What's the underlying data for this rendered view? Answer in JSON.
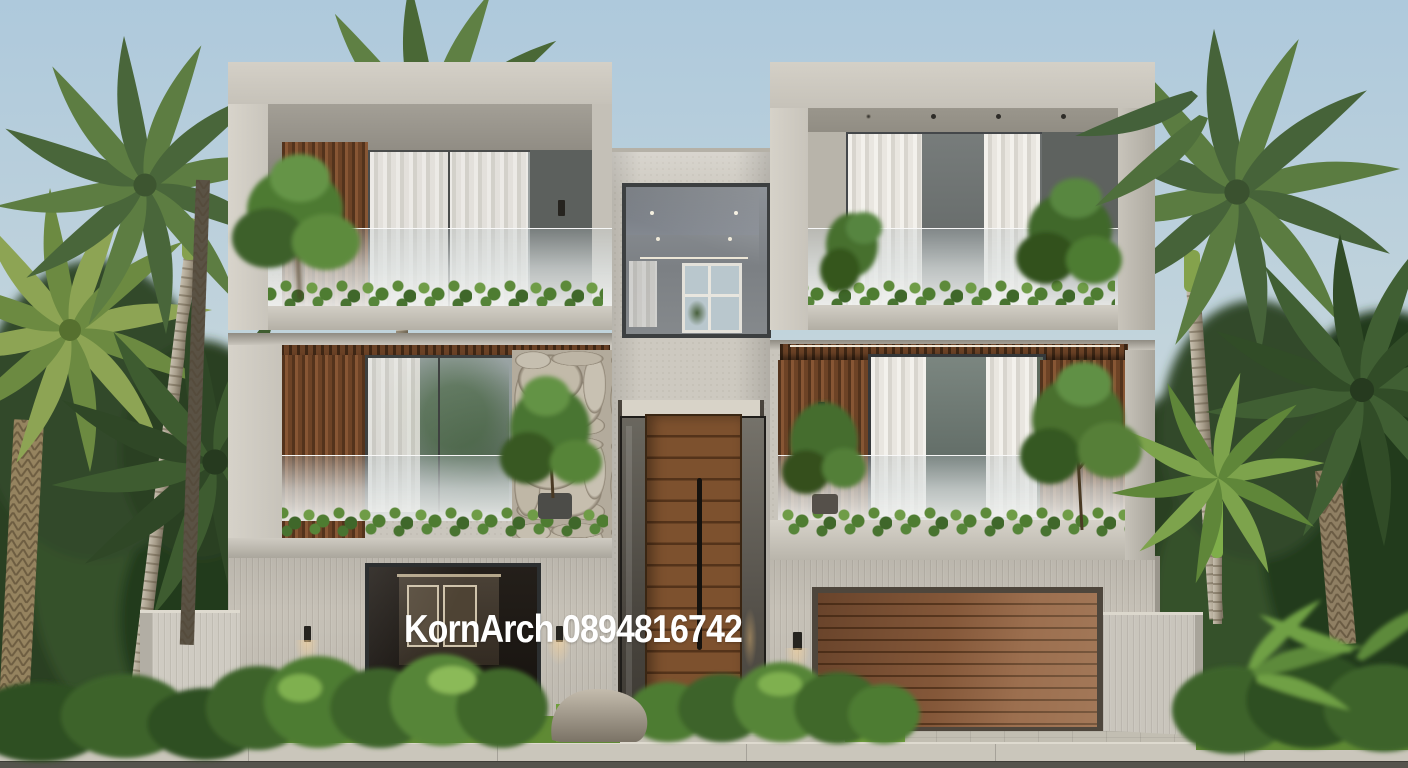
{
  "watermark": {
    "text": "KornArch 0894816742",
    "color": "#ffffff"
  },
  "scene": {
    "type": "3d-architectural-exterior-render",
    "subject": "modern three-storey concrete villa with wood accents, planted balconies, double garage and tropical palms",
    "time_of_day": "day",
    "palette": {
      "sky_top": "#aec9dc",
      "sky_horizon": "#e4e6e0",
      "concrete_light": "#d4d0c7",
      "concrete": "#cdc9c0",
      "concrete_shadow": "#8f8b82",
      "wood_slats": "#6d4326",
      "entry_door_wood": "#7d512e",
      "garage_door_wood": "#8a5a38",
      "glass_reflection": "#9aa4a4",
      "curtain_white": "#e9e6e0",
      "stone_wall": "#b6ae9f",
      "palm_green": "#5d7d42",
      "jungle_green": "#2e4526",
      "shrub_green": "#4e7c33",
      "grass_green": "#6f9a3b",
      "paving": "#c9c5ba",
      "road_asphalt": "#55544d"
    }
  }
}
